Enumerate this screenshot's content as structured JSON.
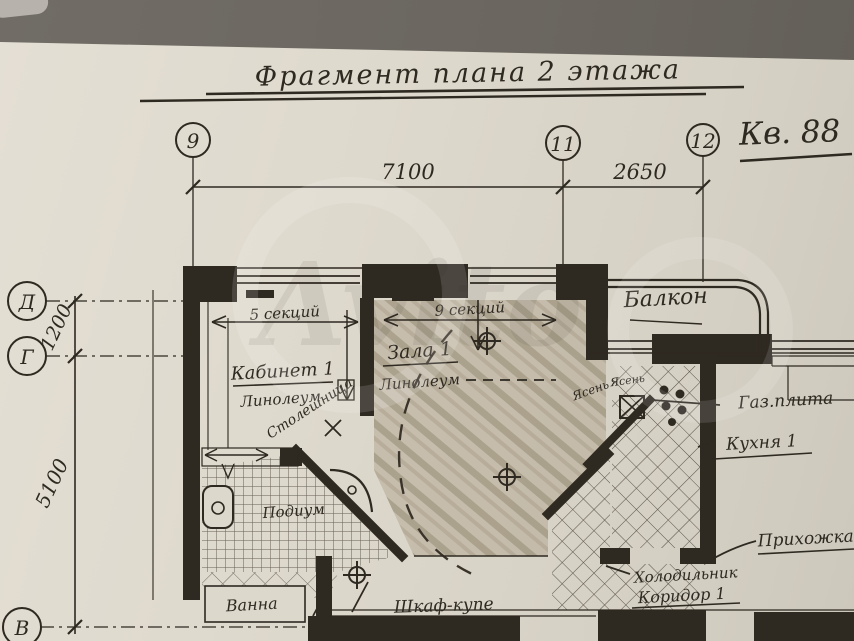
{
  "photo": {
    "background_color": "#6b6660",
    "paper_color": "#ded9cd",
    "ink_color": "#2e2921",
    "pencil_shade_color": "#b0a390",
    "watermark_text": "Avito"
  },
  "title": "Фрагмент плана 2 этажа",
  "apartment_label": "Кв. 88",
  "grid": {
    "columns": [
      "9",
      "11",
      "12"
    ],
    "rows": [
      "Д",
      "Г",
      "В"
    ]
  },
  "dimensions": {
    "span_9_11": "7100",
    "span_11_12": "2650",
    "span_d_g": "1200",
    "span_g_v": "5100"
  },
  "annotations": {
    "radiator_left": "5 секций",
    "radiator_right": "9 секций",
    "kabinet": "Кабинет 1",
    "kabinet_floor": "Линолеум",
    "countertop": "Столешница",
    "zala": "Зала 1",
    "zala_floor": "Линолеум",
    "balcony": "Балкон",
    "gas_stove": "Газ.плита",
    "kitchen": "Кухня 1",
    "wood_a": "Ясень",
    "wood_b": "Ясень",
    "hallway": "Прихожка",
    "fridge": "Холодильник",
    "corridor": "Коридор 1",
    "podium": "Подиум",
    "bath": "Ванна",
    "wardrobe": "Шкаф-купе"
  }
}
